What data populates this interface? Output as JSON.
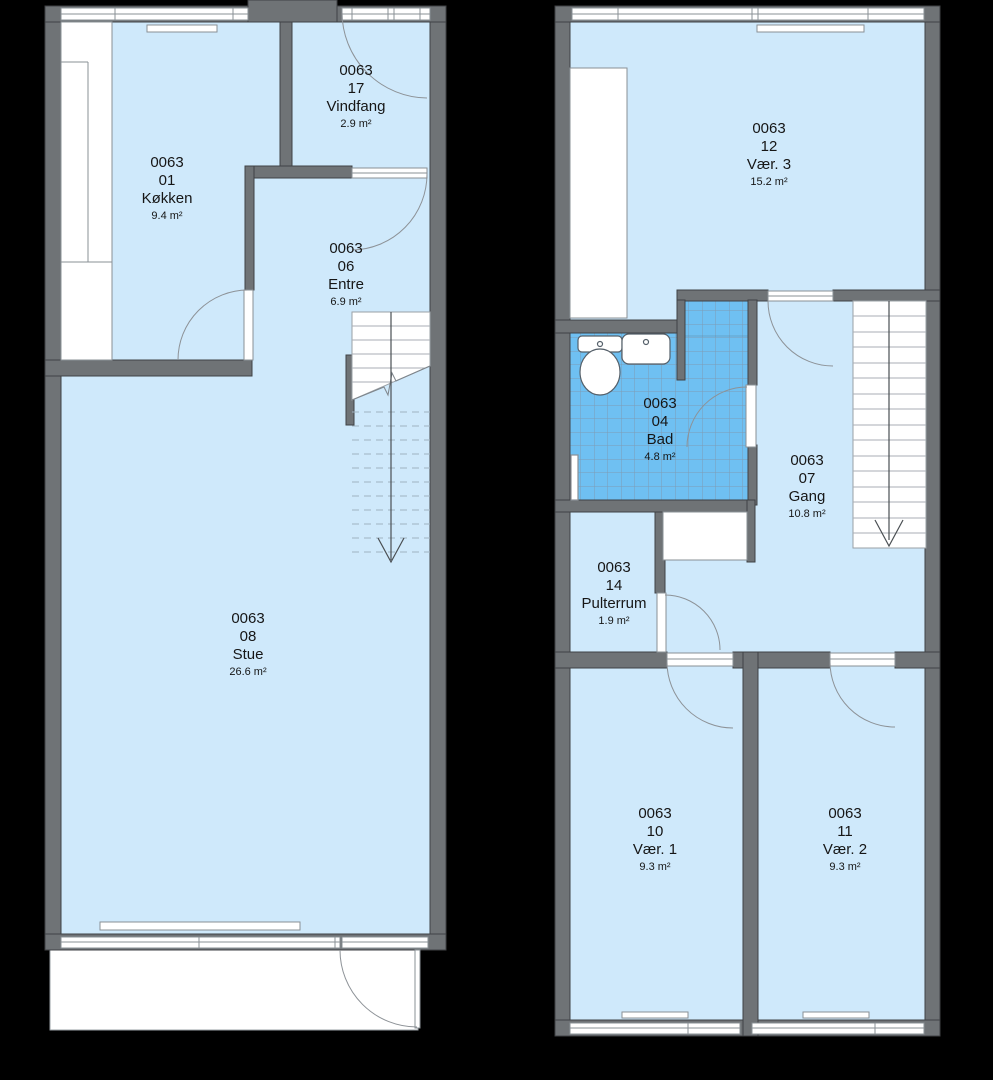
{
  "title": "Floor plan unit 0063",
  "colors": {
    "background": "#000000",
    "room_fill": "#cfe9fb",
    "bath_fill": "#6fc0f2",
    "bath_grid": "#7d9cb5",
    "wall_fill": "#6f7376",
    "wall_outline": "#3f4245",
    "fixture_white": "#ffffff",
    "door_arc": "#8d9297",
    "text": "#161616"
  },
  "plans": [
    {
      "id": "ground-floor",
      "rooms": [
        {
          "key": "kokken",
          "unit": "0063",
          "number": "01",
          "name": "Køkken",
          "area": "9.4 m²"
        },
        {
          "key": "vindfang",
          "unit": "0063",
          "number": "17",
          "name": "Vindfang",
          "area": "2.9 m²"
        },
        {
          "key": "entre",
          "unit": "0063",
          "number": "06",
          "name": "Entre",
          "area": "6.9 m²"
        },
        {
          "key": "stue",
          "unit": "0063",
          "number": "08",
          "name": "Stue",
          "area": "26.6 m²"
        }
      ]
    },
    {
      "id": "upper-floor",
      "rooms": [
        {
          "key": "vaer3",
          "unit": "0063",
          "number": "12",
          "name": "Vær. 3",
          "area": "15.2 m²"
        },
        {
          "key": "bad",
          "unit": "0063",
          "number": "04",
          "name": "Bad",
          "area": "4.8 m²"
        },
        {
          "key": "gang",
          "unit": "0063",
          "number": "07",
          "name": "Gang",
          "area": "10.8 m²"
        },
        {
          "key": "pulterrum",
          "unit": "0063",
          "number": "14",
          "name": "Pulterrum",
          "area": "1.9 m²"
        },
        {
          "key": "vaer1",
          "unit": "0063",
          "number": "10",
          "name": "Vær. 1",
          "area": "9.3 m²"
        },
        {
          "key": "vaer2",
          "unit": "0063",
          "number": "11",
          "name": "Vær. 2",
          "area": "9.3 m²"
        }
      ]
    }
  ]
}
